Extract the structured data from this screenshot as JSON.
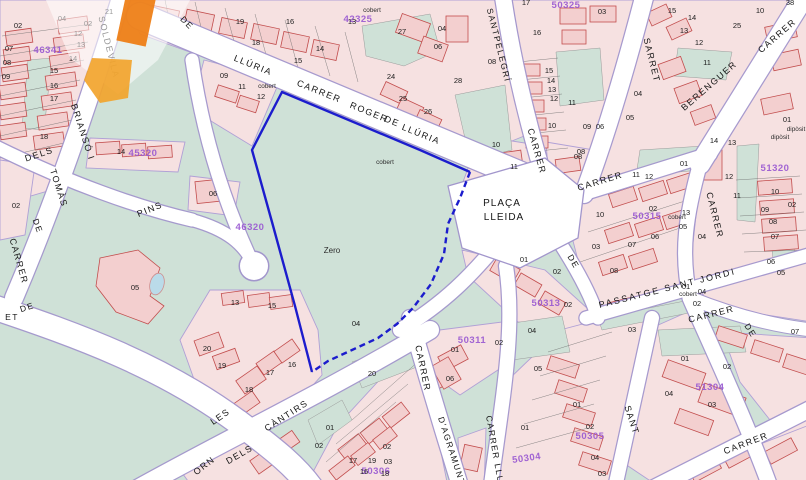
{
  "map": {
    "colors": {
      "green_area": "#cfe1d7",
      "block_pink": "#f6e1e1",
      "building_outline": "#c24d4d",
      "road_white": "#ffffff",
      "road_edge_violet": "#a296cc",
      "selected_parcel_blue": "#1c1ccd",
      "block_code_purple": "#9a5ad2",
      "pool_blue": "#badbe9",
      "logo_orange": "#ee7c10"
    },
    "selected_parcel": {
      "name_label": "Zero",
      "number": "04",
      "annotation": "cobert"
    },
    "place": {
      "name": "PLAÇA LLEIDA"
    },
    "street_labels": [
      {
        "t": "LLÚRIA",
        "x": 252,
        "y": 68,
        "r": 22
      },
      {
        "t": "CARRER",
        "x": 318,
        "y": 94,
        "r": 22
      },
      {
        "t": "ROGER",
        "x": 368,
        "y": 115,
        "r": 22
      },
      {
        "t": "DE",
        "x": 391,
        "y": 124,
        "r": 22
      },
      {
        "t": "LLÚRIA",
        "x": 420,
        "y": 137,
        "r": 22
      },
      {
        "t": "SANTPELEGRÍ",
        "x": 496,
        "y": 46,
        "r": 76,
        "s": 8.5
      },
      {
        "t": "CARRER",
        "x": 534,
        "y": 152,
        "r": 74
      },
      {
        "t": "DE",
        "x": 571,
        "y": 263,
        "r": 60,
        "s": 8.5
      },
      {
        "t": "SARRET",
        "x": 649,
        "y": 61,
        "r": 76
      },
      {
        "t": "CARRER",
        "x": 779,
        "y": 38,
        "r": -41
      },
      {
        "t": "BERENGUER",
        "x": 711,
        "y": 88,
        "r": -41
      },
      {
        "t": "CARRER",
        "x": 601,
        "y": 184,
        "r": -17
      },
      {
        "t": "CARRER",
        "x": 712,
        "y": 216,
        "r": 76
      },
      {
        "t": "PASSATGE SANT JORDI",
        "x": 668,
        "y": 291,
        "r": -14,
        "s": 9,
        "ls": 2
      },
      {
        "t": "CARRER",
        "x": 712,
        "y": 317,
        "r": -14
      },
      {
        "t": "DE",
        "x": 748,
        "y": 332,
        "r": 58,
        "s": 8.5
      },
      {
        "t": "SANT",
        "x": 629,
        "y": 421,
        "r": 72
      },
      {
        "t": "CARRER",
        "x": 747,
        "y": 446,
        "r": -21
      },
      {
        "t": "CARRER",
        "x": 420,
        "y": 369,
        "r": 78
      },
      {
        "t": "D'AGRAMUNT",
        "x": 449,
        "y": 452,
        "r": 72,
        "s": 8.5
      },
      {
        "t": "CARRER LLU",
        "x": 492,
        "y": 450,
        "r": 80,
        "s": 8.5
      },
      {
        "t": "CARRER",
        "x": 16,
        "y": 262,
        "r": 74
      },
      {
        "t": "DE",
        "x": 35,
        "y": 227,
        "r": 70,
        "s": 8.5
      },
      {
        "t": "TOMÀS",
        "x": 56,
        "y": 189,
        "r": 72
      },
      {
        "t": "BRIANSÓ I",
        "x": 80,
        "y": 133,
        "r": 72
      },
      {
        "t": "SOLDEVILA",
        "x": 106,
        "y": 48,
        "r": 76
      },
      {
        "t": "DE",
        "x": 185,
        "y": 25,
        "r": 45,
        "s": 8.5
      },
      {
        "t": "DELS",
        "x": 40,
        "y": 157,
        "r": -18
      },
      {
        "t": "PINS",
        "x": 151,
        "y": 212,
        "r": -22
      },
      {
        "t": "DE",
        "x": 28,
        "y": 310,
        "r": -18,
        "s": 8.5
      },
      {
        "t": "ET",
        "x": 12,
        "y": 320,
        "r": 0,
        "s": 8.5
      },
      {
        "t": "LES",
        "x": 222,
        "y": 419,
        "r": -35
      },
      {
        "t": "CÀNTIRS",
        "x": 288,
        "y": 418,
        "r": -33
      },
      {
        "t": "DELS",
        "x": 241,
        "y": 457,
        "r": -30
      },
      {
        "t": "ORN",
        "x": 206,
        "y": 468,
        "r": -38
      },
      {
        "t": "PLAÇA",
        "x": 502,
        "y": 206,
        "r": 0,
        "s": 10,
        "ls": 1
      },
      {
        "t": "LLEIDA",
        "x": 504,
        "y": 220,
        "r": 0,
        "s": 10,
        "ls": 1
      }
    ],
    "block_codes": [
      {
        "t": "42325",
        "x": 358,
        "y": 22
      },
      {
        "t": "50325",
        "x": 566,
        "y": 8
      },
      {
        "t": "46341",
        "x": 48,
        "y": 53
      },
      {
        "t": "45320",
        "x": 143,
        "y": 156
      },
      {
        "t": "46320",
        "x": 250,
        "y": 230
      },
      {
        "t": "50315",
        "x": 647,
        "y": 219
      },
      {
        "t": "51320",
        "x": 775,
        "y": 171
      },
      {
        "t": "50313",
        "x": 546,
        "y": 306
      },
      {
        "t": "50311",
        "x": 472,
        "y": 343
      },
      {
        "t": "51304",
        "x": 710,
        "y": 390
      },
      {
        "t": "50305",
        "x": 590,
        "y": 439
      },
      {
        "t": "50304",
        "x": 527,
        "y": 461,
        "r": -8
      },
      {
        "t": "50306",
        "x": 376,
        "y": 474
      }
    ],
    "parcel_numbers": [
      {
        "t": "21",
        "x": 109,
        "y": 14
      },
      {
        "t": "02",
        "x": 88,
        "y": 26
      },
      {
        "t": "12",
        "x": 78,
        "y": 36
      },
      {
        "t": "13",
        "x": 81,
        "y": 47
      },
      {
        "t": "14",
        "x": 73,
        "y": 61
      },
      {
        "t": "15",
        "x": 54,
        "y": 73
      },
      {
        "t": "16",
        "x": 54,
        "y": 88
      },
      {
        "t": "17",
        "x": 54,
        "y": 101
      },
      {
        "t": "18",
        "x": 44,
        "y": 139
      },
      {
        "t": "04",
        "x": 62,
        "y": 21
      },
      {
        "t": "02",
        "x": 18,
        "y": 28
      },
      {
        "t": "07",
        "x": 9,
        "y": 51
      },
      {
        "t": "08",
        "x": 7,
        "y": 65
      },
      {
        "t": "09",
        "x": 6,
        "y": 79
      },
      {
        "t": "19",
        "x": 240,
        "y": 24
      },
      {
        "t": "16",
        "x": 290,
        "y": 24
      },
      {
        "t": "18",
        "x": 256,
        "y": 45
      },
      {
        "t": "15",
        "x": 298,
        "y": 63
      },
      {
        "t": "14",
        "x": 320,
        "y": 51
      },
      {
        "t": "13",
        "x": 352,
        "y": 24
      },
      {
        "t": "27",
        "x": 402,
        "y": 34
      },
      {
        "t": "24",
        "x": 391,
        "y": 79
      },
      {
        "t": "25",
        "x": 403,
        "y": 101
      },
      {
        "t": "26",
        "x": 428,
        "y": 114
      },
      {
        "t": "28",
        "x": 458,
        "y": 83
      },
      {
        "t": "04",
        "x": 442,
        "y": 31
      },
      {
        "t": "06",
        "x": 438,
        "y": 49
      },
      {
        "t": "08",
        "x": 492,
        "y": 64
      },
      {
        "t": "10",
        "x": 496,
        "y": 147
      },
      {
        "t": "09",
        "x": 224,
        "y": 78
      },
      {
        "t": "11",
        "x": 242,
        "y": 89
      },
      {
        "t": "12",
        "x": 261,
        "y": 99
      },
      {
        "t": "17",
        "x": 526,
        "y": 5
      },
      {
        "t": "03",
        "x": 602,
        "y": 14
      },
      {
        "t": "16",
        "x": 537,
        "y": 35
      },
      {
        "t": "15",
        "x": 549,
        "y": 73
      },
      {
        "t": "14",
        "x": 551,
        "y": 83
      },
      {
        "t": "13",
        "x": 552,
        "y": 92
      },
      {
        "t": "12",
        "x": 554,
        "y": 101
      },
      {
        "t": "11",
        "x": 572,
        "y": 105
      },
      {
        "t": "10",
        "x": 552,
        "y": 128
      },
      {
        "t": "09",
        "x": 587,
        "y": 129
      },
      {
        "t": "06",
        "x": 600,
        "y": 129
      },
      {
        "t": "08",
        "x": 581,
        "y": 154
      },
      {
        "t": "15",
        "x": 672,
        "y": 13
      },
      {
        "t": "14",
        "x": 692,
        "y": 20
      },
      {
        "t": "13",
        "x": 684,
        "y": 33
      },
      {
        "t": "12",
        "x": 699,
        "y": 45
      },
      {
        "t": "11",
        "x": 707,
        "y": 65
      },
      {
        "t": "25",
        "x": 737,
        "y": 28
      },
      {
        "t": "10",
        "x": 760,
        "y": 13
      },
      {
        "t": "04",
        "x": 638,
        "y": 96
      },
      {
        "t": "05",
        "x": 630,
        "y": 120
      },
      {
        "t": "38",
        "x": 790,
        "y": 5
      },
      {
        "t": "01",
        "x": 787,
        "y": 122
      },
      {
        "t": "10",
        "x": 775,
        "y": 194
      },
      {
        "t": "02",
        "x": 792,
        "y": 207
      },
      {
        "t": "09",
        "x": 765,
        "y": 212
      },
      {
        "t": "08",
        "x": 773,
        "y": 224
      },
      {
        "t": "07",
        "x": 775,
        "y": 239
      },
      {
        "t": "06",
        "x": 771,
        "y": 264
      },
      {
        "t": "05",
        "x": 781,
        "y": 275
      },
      {
        "t": "14",
        "x": 714,
        "y": 143
      },
      {
        "t": "13",
        "x": 732,
        "y": 145
      },
      {
        "t": "12",
        "x": 729,
        "y": 179
      },
      {
        "t": "11",
        "x": 737,
        "y": 198
      },
      {
        "t": "04",
        "x": 702,
        "y": 239
      },
      {
        "t": "08",
        "x": 578,
        "y": 159
      },
      {
        "t": "11",
        "x": 514,
        "y": 169
      },
      {
        "t": "01",
        "x": 684,
        "y": 166
      },
      {
        "t": "11",
        "x": 636,
        "y": 177
      },
      {
        "t": "12",
        "x": 649,
        "y": 179
      },
      {
        "t": "02",
        "x": 653,
        "y": 211
      },
      {
        "t": "13",
        "x": 686,
        "y": 215
      },
      {
        "t": "10",
        "x": 600,
        "y": 217
      },
      {
        "t": "05",
        "x": 683,
        "y": 229
      },
      {
        "t": "06",
        "x": 655,
        "y": 239
      },
      {
        "t": "07",
        "x": 632,
        "y": 247
      },
      {
        "t": "03",
        "x": 596,
        "y": 249
      },
      {
        "t": "08",
        "x": 614,
        "y": 273
      },
      {
        "t": "01",
        "x": 524,
        "y": 262
      },
      {
        "t": "02",
        "x": 557,
        "y": 274
      },
      {
        "t": "02",
        "x": 568,
        "y": 307
      },
      {
        "t": "01",
        "x": 686,
        "y": 289
      },
      {
        "t": "04",
        "x": 702,
        "y": 294
      },
      {
        "t": "02",
        "x": 697,
        "y": 306
      },
      {
        "t": "07",
        "x": 795,
        "y": 334
      },
      {
        "t": "03",
        "x": 632,
        "y": 332
      },
      {
        "t": "01",
        "x": 685,
        "y": 361
      },
      {
        "t": "02",
        "x": 727,
        "y": 369
      },
      {
        "t": "04",
        "x": 669,
        "y": 396
      },
      {
        "t": "03",
        "x": 712,
        "y": 407
      },
      {
        "t": "01",
        "x": 577,
        "y": 407
      },
      {
        "t": "02",
        "x": 590,
        "y": 429
      },
      {
        "t": "04",
        "x": 595,
        "y": 460
      },
      {
        "t": "03",
        "x": 602,
        "y": 476
      },
      {
        "t": "01",
        "x": 525,
        "y": 430
      },
      {
        "t": "04",
        "x": 532,
        "y": 333
      },
      {
        "t": "05",
        "x": 538,
        "y": 371
      },
      {
        "t": "20",
        "x": 207,
        "y": 351
      },
      {
        "t": "19",
        "x": 222,
        "y": 368
      },
      {
        "t": "18",
        "x": 249,
        "y": 392
      },
      {
        "t": "17",
        "x": 270,
        "y": 375
      },
      {
        "t": "16",
        "x": 292,
        "y": 367
      },
      {
        "t": "13",
        "x": 235,
        "y": 305
      },
      {
        "t": "15",
        "x": 272,
        "y": 308
      },
      {
        "t": "05",
        "x": 135,
        "y": 290
      },
      {
        "t": "06",
        "x": 213,
        "y": 196
      },
      {
        "t": "02",
        "x": 16,
        "y": 208
      },
      {
        "t": "14",
        "x": 121,
        "y": 154
      },
      {
        "t": "04",
        "x": 356,
        "y": 326
      },
      {
        "t": "01",
        "x": 330,
        "y": 430
      },
      {
        "t": "20",
        "x": 372,
        "y": 376
      },
      {
        "t": "02",
        "x": 387,
        "y": 449
      },
      {
        "t": "17",
        "x": 353,
        "y": 463
      },
      {
        "t": "19",
        "x": 372,
        "y": 463
      },
      {
        "t": "03",
        "x": 388,
        "y": 464
      },
      {
        "t": "16",
        "x": 364,
        "y": 474
      },
      {
        "t": "18",
        "x": 385,
        "y": 476
      },
      {
        "t": "02",
        "x": 319,
        "y": 448
      },
      {
        "t": "06",
        "x": 450,
        "y": 381
      },
      {
        "t": "01",
        "x": 455,
        "y": 352
      },
      {
        "t": "02",
        "x": 499,
        "y": 345
      }
    ],
    "annotations": [
      {
        "t": "cobert",
        "x": 267,
        "y": 88
      },
      {
        "t": "cobert",
        "x": 372,
        "y": 12
      },
      {
        "t": "cobert",
        "x": 385,
        "y": 164
      },
      {
        "t": "cobert",
        "x": 677,
        "y": 219
      },
      {
        "t": "cobert",
        "x": 688,
        "y": 296
      },
      {
        "t": "dipòsit",
        "x": 780,
        "y": 139
      },
      {
        "t": "dipòsit",
        "x": 796,
        "y": 131
      },
      {
        "t": "Zero",
        "x": 332,
        "y": 253,
        "s": 8
      }
    ]
  }
}
